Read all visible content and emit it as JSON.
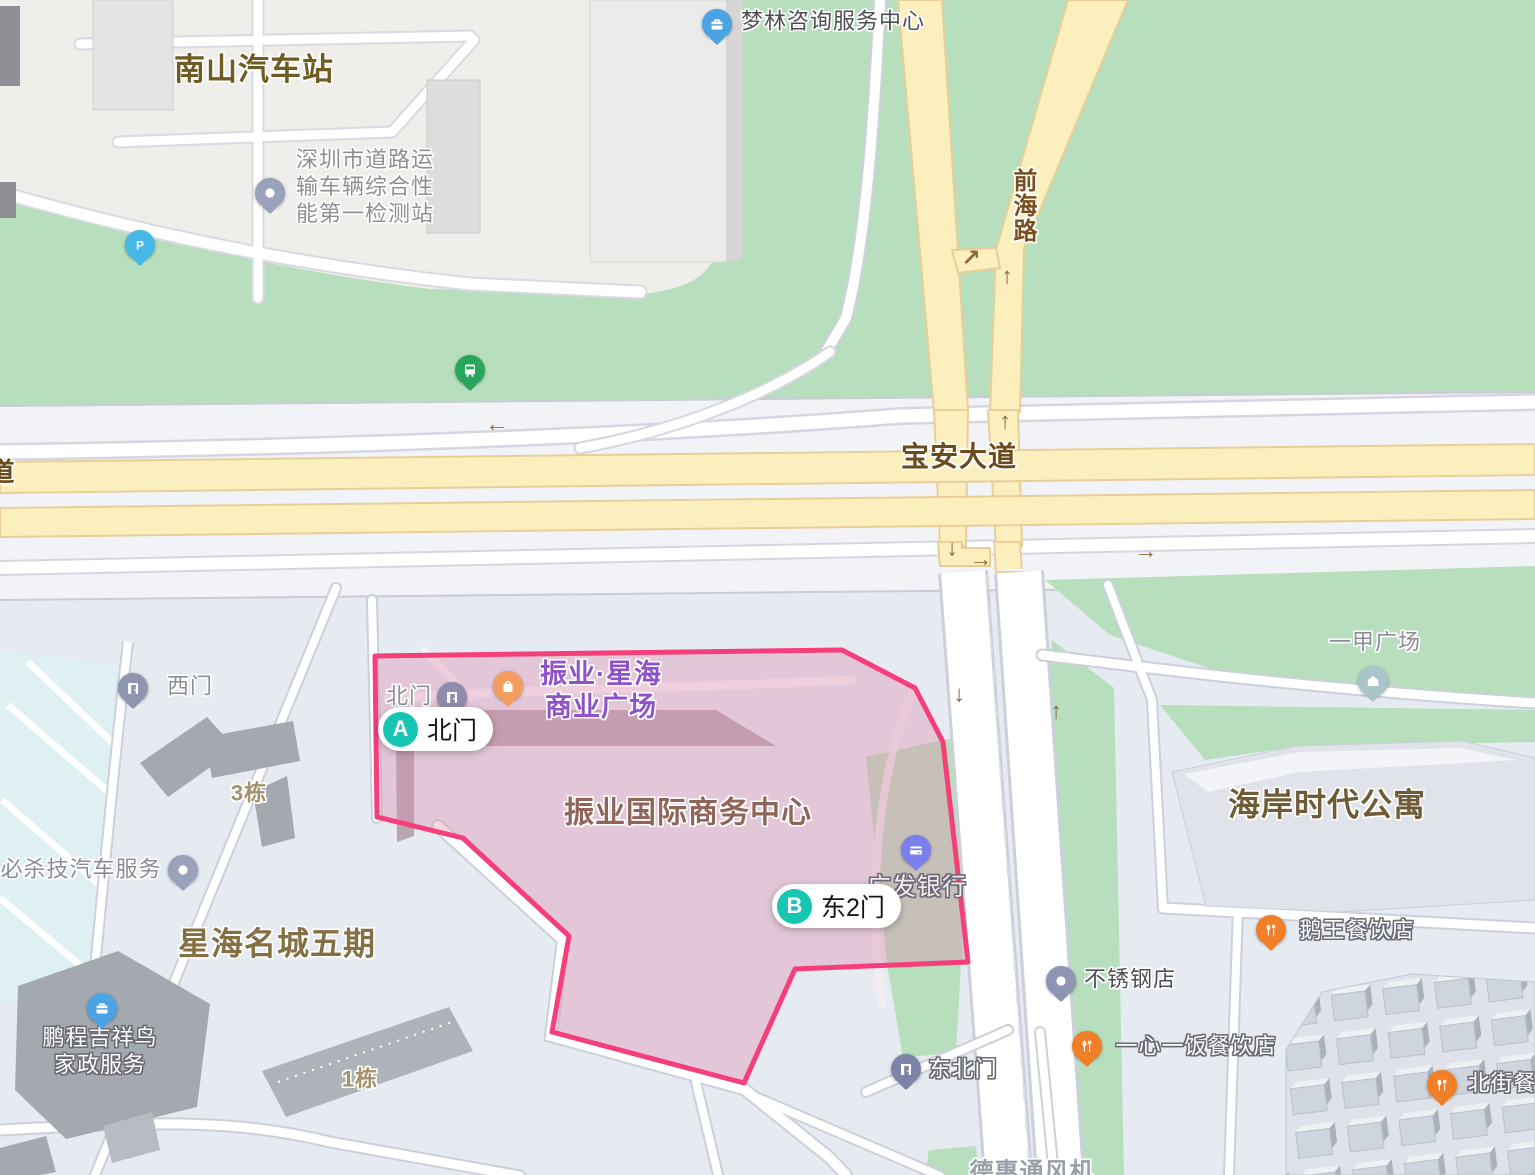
{
  "highlight": {
    "name": "振业国际商务中心",
    "border_color": "#f43f7b",
    "fill_color": "rgba(223,142,177,0.38)",
    "marker_color": "#17c6b2",
    "gates": {
      "a": {
        "letter": "A",
        "label": "北门",
        "x": 378,
        "y": 707
      },
      "b": {
        "letter": "B",
        "label": "东2门",
        "x": 772,
        "y": 884
      }
    }
  },
  "area_labels": [
    {
      "id": "nanshan-bus-station",
      "text": "南山汽车站",
      "x": 254,
      "y": 70,
      "fs": 31,
      "color": "#6e5c22",
      "bold": true
    },
    {
      "id": "xinghai-mingcheng-5",
      "text": "星海名城五期",
      "x": 277,
      "y": 944,
      "fs": 32,
      "color": "#857045",
      "bold": true
    },
    {
      "id": "haian-shidai-apartment",
      "text": "海岸时代公寓",
      "x": 1327,
      "y": 805,
      "fs": 32,
      "color": "#6f5b35",
      "bold": true
    },
    {
      "id": "zhenye-intl-business-center",
      "text": "振业国际商务中心",
      "x": 688,
      "y": 814,
      "fs": 30,
      "color": "#8f655a",
      "bold": true
    },
    {
      "id": "building-3",
      "text": "3栋",
      "x": 249,
      "y": 794,
      "fs": 22,
      "color": "#a5916a",
      "bold": true
    },
    {
      "id": "building-1",
      "text": "1栋",
      "x": 360,
      "y": 1080,
      "fs": 22,
      "color": "#a5916a",
      "bold": true
    },
    {
      "id": "dehui-fan",
      "text": "德惠通风机",
      "x": 1032,
      "y": 1172,
      "fs": 24,
      "color": "#9aa0a8",
      "bold": true
    }
  ],
  "road_labels": [
    {
      "id": "baoan-avenue",
      "text": "宝安大道",
      "x": 959,
      "y": 457,
      "fs": 28,
      "color": "#6b4a1c",
      "bold": true
    },
    {
      "id": "qianhai-road",
      "text": "前海路",
      "x": 1022,
      "y": 168,
      "fs": 24,
      "color": "#7a4e1d",
      "bold": true,
      "vertical": true
    },
    {
      "id": "road-name-partial",
      "text": "道",
      "x": 2,
      "y": 473,
      "fs": 26,
      "color": "#6b4a1c",
      "bold": true
    }
  ],
  "pois": [
    {
      "id": "shenzhen-vehicle-test-station",
      "text": "深圳市道路运\n输车辆综合性\n能第一检测站",
      "x": 365,
      "y": 187,
      "fs": 22,
      "color": "#8f8f93",
      "halo": "light",
      "pin": {
        "icon": "dot-icon",
        "color": "#9aa2bb",
        "x": 270,
        "y": 193
      }
    },
    {
      "id": "menglin-consulting",
      "text": "梦林咨询服务中心",
      "x": 833,
      "y": 22,
      "fs": 22,
      "color": "#4f4f53",
      "halo": "light",
      "pin": {
        "icon": "briefcase-icon",
        "color": "#4ba3e3",
        "x": 717,
        "y": 24
      }
    },
    {
      "id": "zhenye-xinghai-plaza",
      "text": "振业·星海\n商业广场",
      "x": 601,
      "y": 691,
      "fs": 27,
      "color": "#8f52c9",
      "bold": true,
      "halo": "light",
      "pin": {
        "icon": "shopping-bag-icon",
        "color": "#f29d5e",
        "x": 508,
        "y": 686
      }
    },
    {
      "id": "north-gate-small",
      "text": "北门",
      "x": 409,
      "y": 697,
      "fs": 22,
      "color": "#8e8e96",
      "halo": "light",
      "pin": {
        "icon": "door-icon",
        "color": "#8f8bad",
        "x": 452,
        "y": 697
      }
    },
    {
      "id": "west-gate",
      "text": "西门",
      "x": 190,
      "y": 687,
      "fs": 22,
      "color": "#8c8c94",
      "halo": "light",
      "pin": {
        "icon": "door-icon",
        "color": "#8f95ad",
        "x": 133,
        "y": 688
      }
    },
    {
      "id": "bishaji-auto-service",
      "text": "必杀技汽车服务",
      "x": 81,
      "y": 870,
      "fs": 22,
      "color": "#8c8c94",
      "halo": "light",
      "pin": {
        "icon": "dot-icon",
        "color": "#9aa2bb",
        "x": 183,
        "y": 870
      }
    },
    {
      "id": "pengcheng-housekeeping",
      "text": "鹏程吉祥鸟\n家政服务",
      "x": 100,
      "y": 1052,
      "fs": 22,
      "color": "#ffffff",
      "halo": "dark",
      "pin": {
        "icon": "briefcase-icon",
        "color": "#4ba3e3",
        "x": 102,
        "y": 1008
      }
    },
    {
      "id": "guangfa-bank",
      "text": "广发银行",
      "x": 917,
      "y": 887,
      "fs": 24,
      "color": "#f6e9ef",
      "halo": "dark",
      "pin": {
        "icon": "card-icon",
        "color": "#7b80ed",
        "x": 916,
        "y": 850
      }
    },
    {
      "id": "yijia-plaza",
      "text": "一甲广场",
      "x": 1375,
      "y": 643,
      "fs": 22,
      "color": "#8c8c94",
      "halo": "light",
      "pin": {
        "icon": "house-icon",
        "color": "#a9c5c9",
        "x": 1373,
        "y": 681
      }
    },
    {
      "id": "ewang-restaurant",
      "text": "鹅王餐饮店",
      "x": 1357,
      "y": 931,
      "fs": 22,
      "color": "#ffffff",
      "halo": "dark",
      "pin": {
        "icon": "cutlery-icon",
        "color": "#f07f27",
        "x": 1271,
        "y": 930
      }
    },
    {
      "id": "stainless-steel-shop",
      "text": "不锈钢店",
      "x": 1130,
      "y": 980,
      "fs": 22,
      "color": "#4f4f53",
      "halo": "light",
      "pin": {
        "icon": "dot-icon",
        "color": "#8d95b2",
        "x": 1061,
        "y": 981
      }
    },
    {
      "id": "yixinyifan-restaurant",
      "text": "一心一饭餐饮店",
      "x": 1196,
      "y": 1047,
      "fs": 22,
      "color": "#ffffff",
      "halo": "dark",
      "pin": {
        "icon": "cutlery-icon",
        "color": "#f07f27",
        "x": 1087,
        "y": 1046
      }
    },
    {
      "id": "northeast-gate",
      "text": "东北门",
      "x": 963,
      "y": 1070,
      "fs": 22,
      "color": "#ffffff",
      "halo": "dark",
      "pin": {
        "icon": "door-icon",
        "color": "#7d84a8",
        "x": 906,
        "y": 1069
      }
    },
    {
      "id": "beijie-restaurant",
      "text": "北街餐",
      "x": 1502,
      "y": 1084,
      "fs": 22,
      "color": "#ffffff",
      "halo": "dark",
      "pin": {
        "icon": "cutlery-icon",
        "color": "#f07f27",
        "x": 1442,
        "y": 1085
      }
    }
  ],
  "standalone_pins": [
    {
      "id": "parking-pin",
      "icon": "parking-icon",
      "color": "#47b7e6",
      "x": 140,
      "y": 245
    },
    {
      "id": "bus-stop-pin",
      "icon": "bus-icon",
      "color": "#27a65c",
      "x": 470,
      "y": 370
    }
  ],
  "arrows": [
    {
      "id": "arrow-left-1",
      "glyph": "←",
      "x": 497,
      "y": 424
    },
    {
      "id": "arrow-up-1",
      "glyph": "↑",
      "x": 1005,
      "y": 421
    },
    {
      "id": "arrow-down-1",
      "glyph": "↓",
      "x": 952,
      "y": 548
    },
    {
      "id": "arrow-right-1",
      "glyph": "→",
      "x": 981,
      "y": 559
    },
    {
      "id": "arrow-right-2",
      "glyph": "→",
      "x": 1146,
      "y": 551
    },
    {
      "id": "arrow-ne-1",
      "glyph": "↗",
      "x": 971,
      "y": 258
    },
    {
      "id": "arrow-up-2",
      "glyph": "↑",
      "x": 1007,
      "y": 276
    },
    {
      "id": "arrow-down-2",
      "glyph": "↓",
      "x": 959,
      "y": 694
    },
    {
      "id": "arrow-up-3",
      "glyph": "↑",
      "x": 1056,
      "y": 711
    }
  ],
  "colors": {
    "green_area": "#b7dfbd",
    "yellow_road": "#faefbd",
    "yellow_road_casing": "#e8cf9a",
    "block_area": "#f0eeeb",
    "south_area": "#e6eaf1",
    "cyan_area": "#def0f2"
  }
}
